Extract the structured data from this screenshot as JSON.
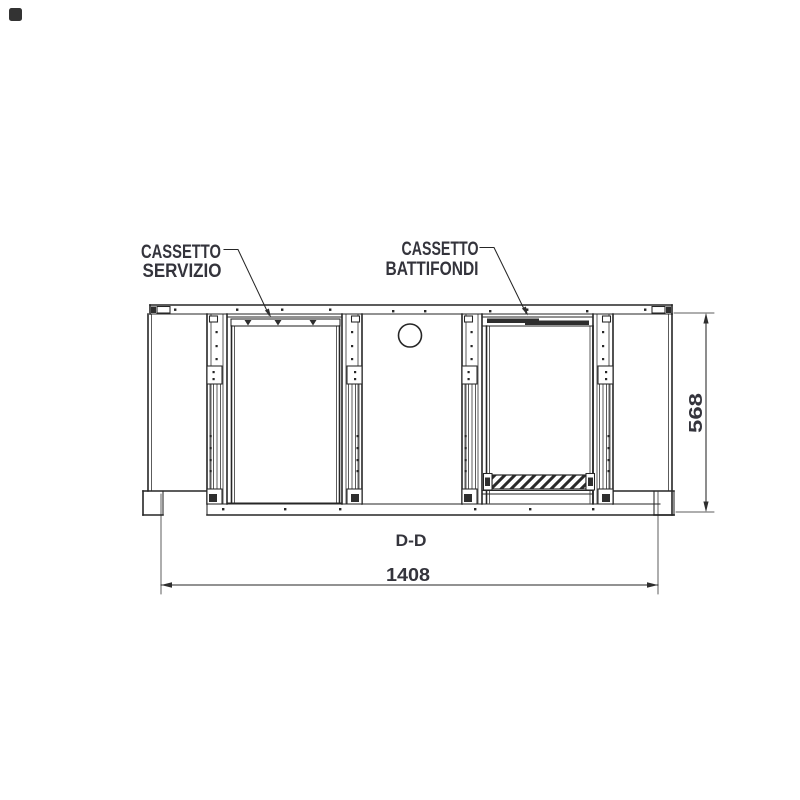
{
  "page": {
    "background": "#ffffff"
  },
  "corner_mark": {
    "color": "#333333"
  },
  "drawing": {
    "section_label": "D-D",
    "callouts": {
      "service_drawer": {
        "line1": "CASSETTO",
        "line2": "SERVIZIO"
      },
      "knockbox_drawer": {
        "line1": "CASSETTO",
        "line2": "BATTIFONDI"
      }
    },
    "dimensions": {
      "overall_width": "1408",
      "overall_height": "568"
    },
    "colors": {
      "line": "#262626",
      "text": "#34343c"
    }
  }
}
